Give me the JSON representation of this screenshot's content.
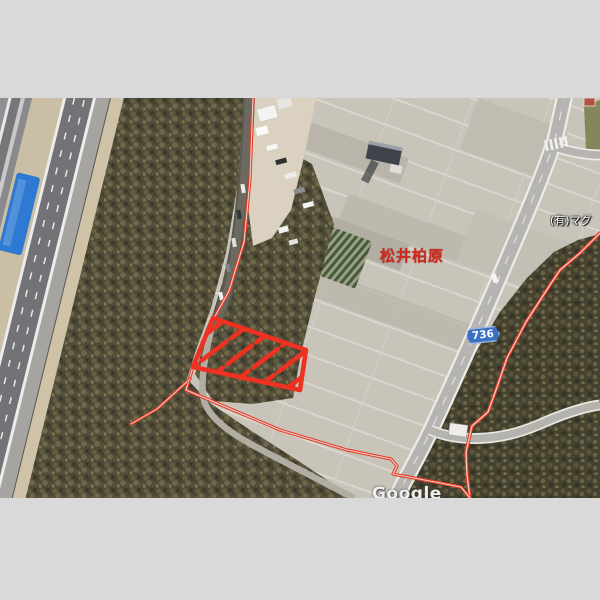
{
  "frame": {
    "letterbox_color": "#d9d9d9"
  },
  "map": {
    "area_label": "松井柏原",
    "business_label": "(有)マグ",
    "route_badge": "736",
    "watermark": "Google",
    "colors": {
      "annotation_red": "#e23b28",
      "parcel_red": "#ee3120",
      "badge_blue": "#3a70c2",
      "badge_text": "#ffffff",
      "area_label_red": "#ce2b1e",
      "forest": "#4f4a37",
      "field": "#c8c4ba",
      "tarp_blue": "#2e79d1"
    }
  }
}
